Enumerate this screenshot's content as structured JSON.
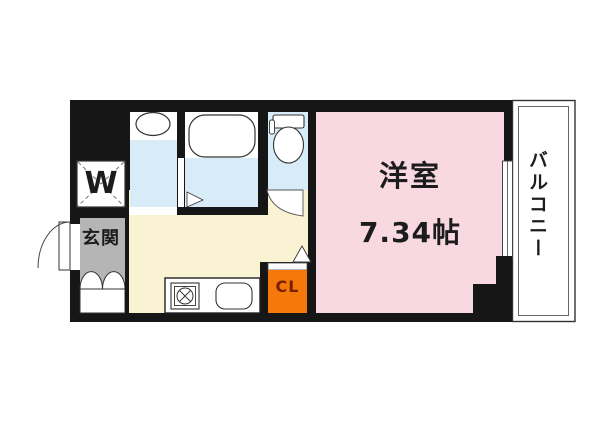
{
  "floorplan": {
    "western_room": {
      "name": "洋室",
      "size": "7.34帖"
    },
    "balcony": {
      "name": "バルコニー"
    },
    "entrance": {
      "name": "玄関"
    },
    "closet": {
      "name": "CL"
    },
    "washer_slot": {
      "name": "W"
    },
    "fixtures": [
      "washbasin",
      "bathtub",
      "toilet",
      "stove",
      "kitchen-sink",
      "shoe-cabinet"
    ],
    "colors": {
      "wall": "#161616",
      "western_room": "#f8d9e2",
      "wet_room": "#d8ecf8",
      "kitchen_hall": "#faf3d3",
      "entrance": "#b5b5b5",
      "closet": "#f4790a",
      "closet_text": "#7c2000",
      "balcony_bg": "#ffffff",
      "fixture_fill": "#ffffff"
    }
  }
}
